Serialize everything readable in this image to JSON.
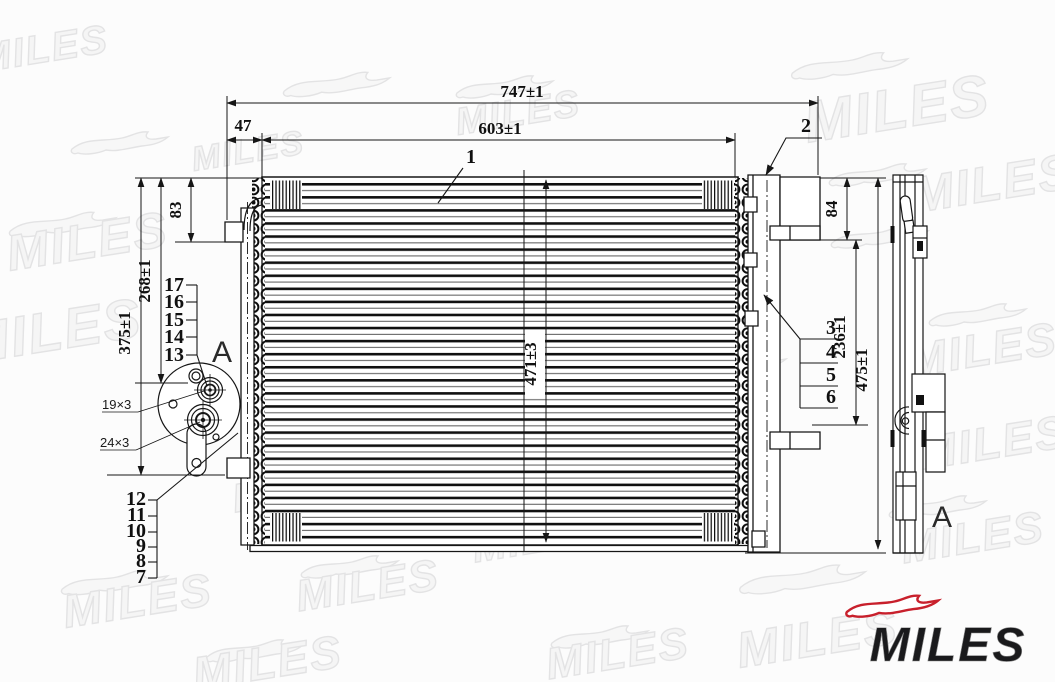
{
  "watermark": {
    "text": "MILES",
    "color": "#e3e3e4"
  },
  "logo": {
    "text": "MILES",
    "text_color": "#1a1a1c",
    "dog_color": "#c8202c"
  },
  "view_labels": {
    "detail_view": "A",
    "side_view": "A"
  },
  "dimensions": {
    "total_width": "747±1",
    "core_width": "603±1",
    "inlet_offset": "47",
    "top_left_offset": "83",
    "left_upper_height": "268±1",
    "left_total_height": "375±1",
    "core_height": "471±3",
    "right_top_offset": "84",
    "right_bracket_span": "236±1",
    "right_total_height": "475±1",
    "port_upper": "19×3",
    "port_lower": "24×3"
  },
  "callouts": {
    "1": "1",
    "2": "2",
    "3": "3",
    "4": "4",
    "5": "5",
    "6": "6",
    "7": "7",
    "8": "8",
    "9": "9",
    "10": "10",
    "11": "11",
    "12": "12",
    "13": "13",
    "14": "14",
    "15": "15",
    "16": "16",
    "17": "17"
  },
  "colors": {
    "line": "#161616",
    "background": "#fcfcfc"
  }
}
